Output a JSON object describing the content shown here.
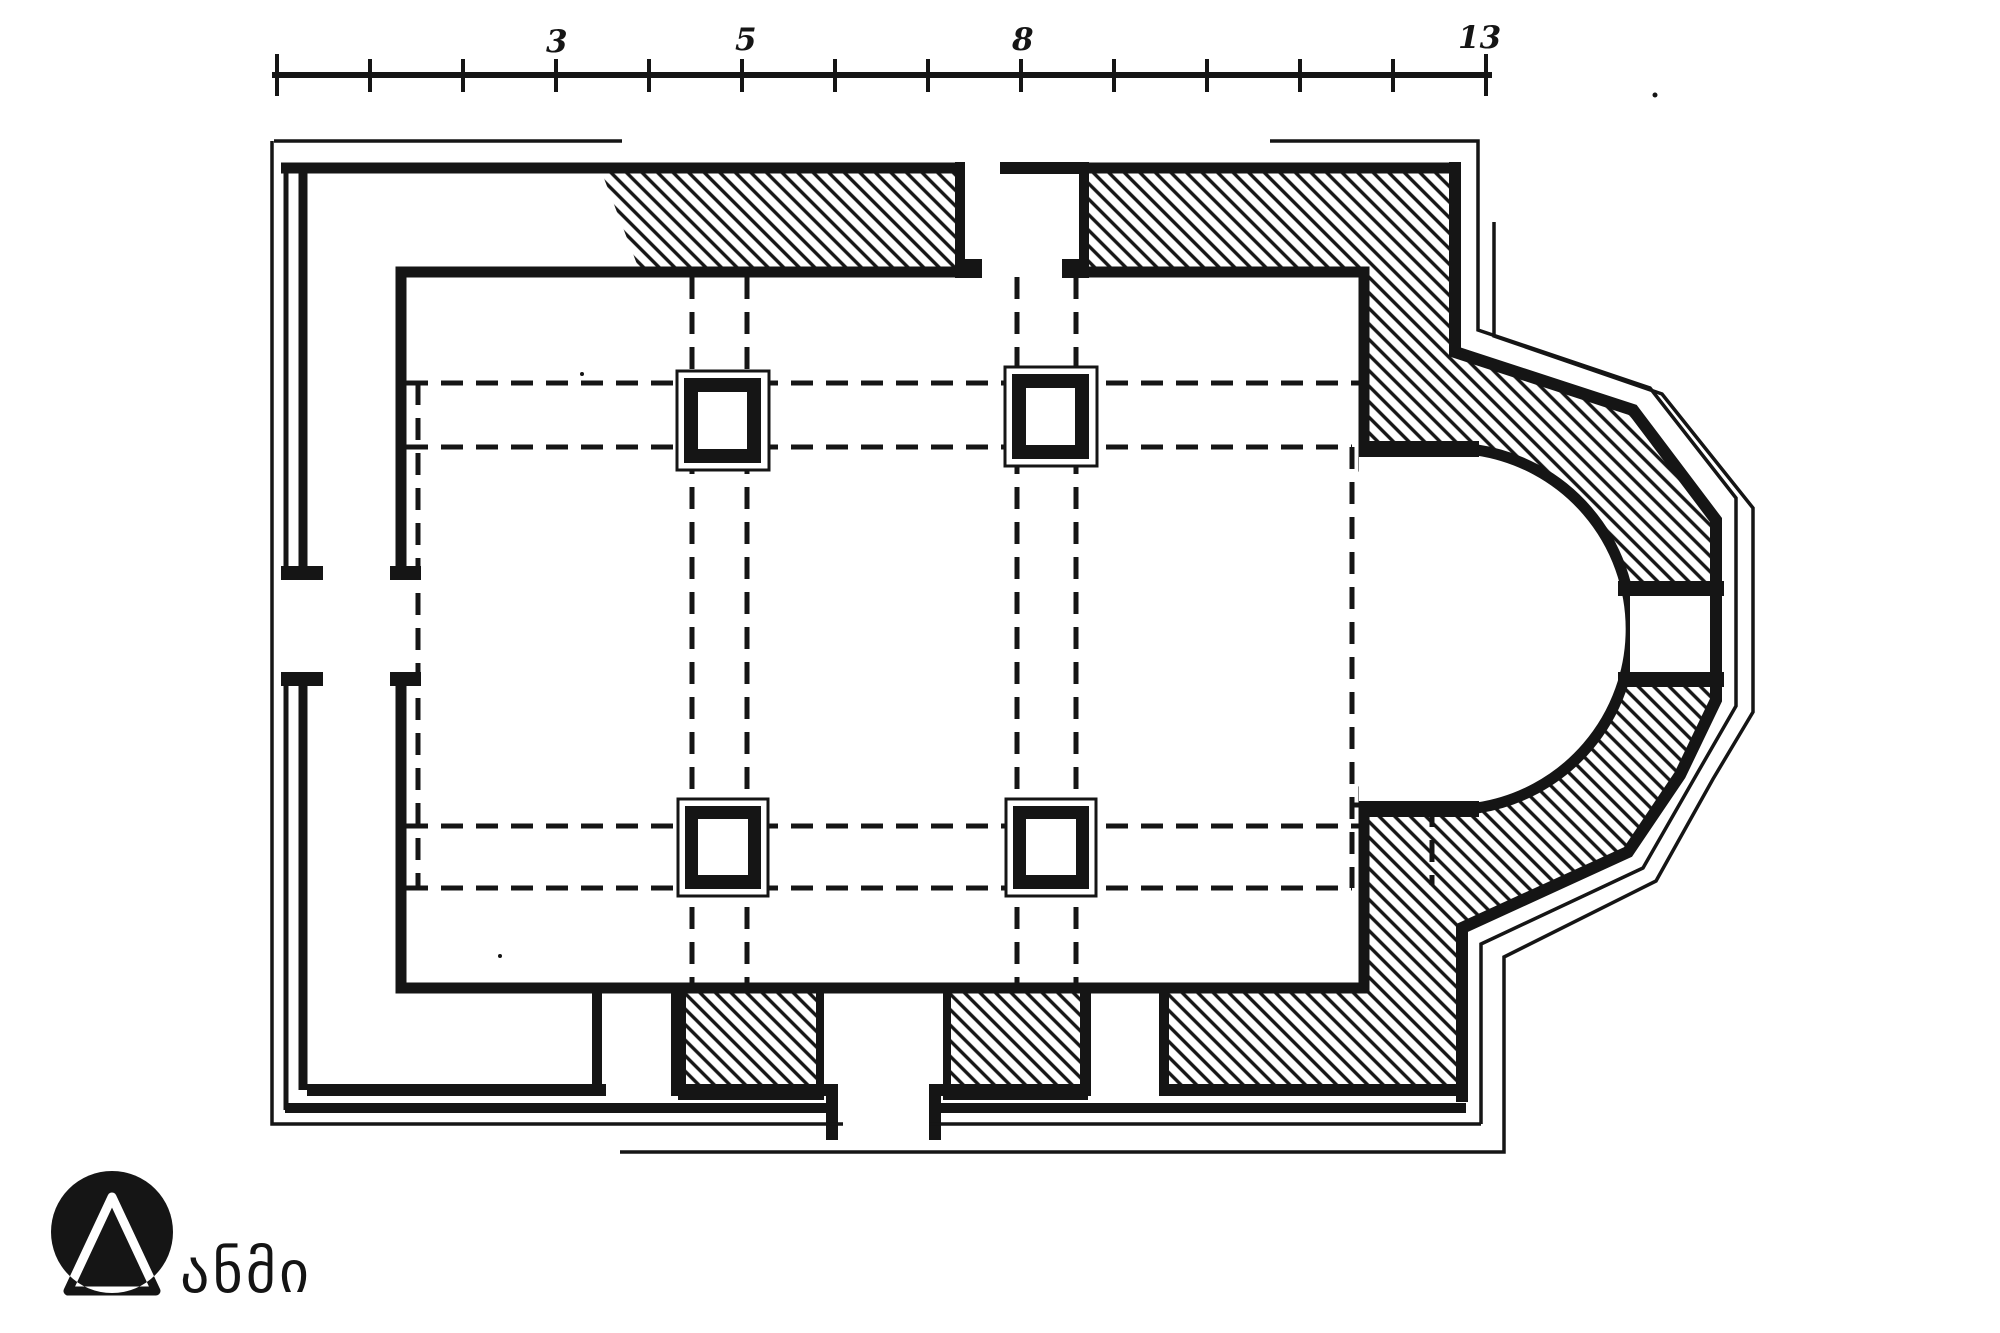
{
  "page": {
    "background": "#ffffff",
    "ink_color": "#151515"
  },
  "drawing": {
    "type": "church floor plan (measured survey drawing)",
    "pillar_count": 4
  },
  "scale_bar": {
    "tick_count": 14,
    "labels": [
      {
        "text": "3"
      },
      {
        "text": "5"
      },
      {
        "text": "8"
      },
      {
        "text": "13"
      }
    ]
  },
  "logo": {
    "text": "ანმი"
  }
}
